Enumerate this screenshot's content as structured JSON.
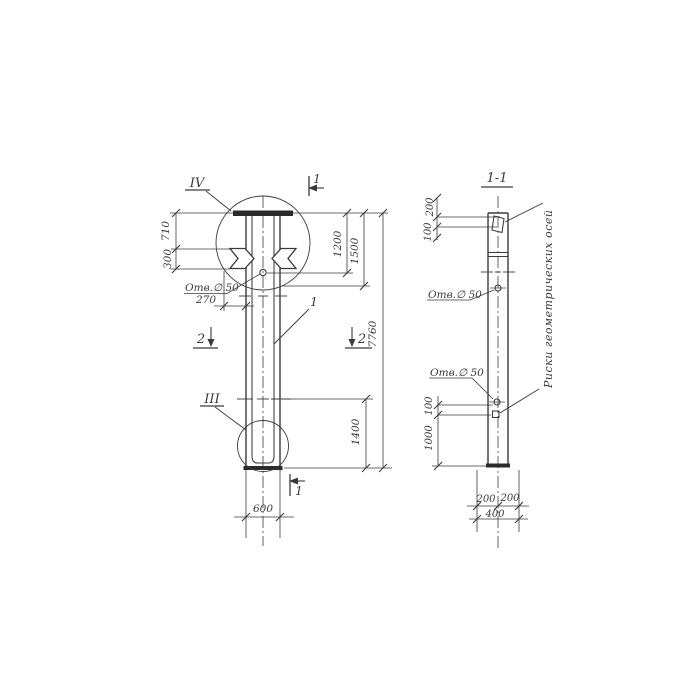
{
  "drawing": {
    "background": "#ffffff",
    "ink": "#3a3a3a",
    "labels": {
      "detail_top": "IV",
      "detail_bottom": "III",
      "section_title": "1-1",
      "section_cut_1": "1",
      "section_cut_2": "2",
      "part_ref": "1",
      "hole": "Отв.∅ 50",
      "axes_note": "Риски геометрических осей"
    },
    "elevation_dims": {
      "d710": "710",
      "d300": "300",
      "d270": "270",
      "d600": "600",
      "d1200": "1200",
      "d1500": "1500",
      "d7760": "7760",
      "d1400": "1400"
    },
    "section_dims": {
      "top_200": "200",
      "top_100": "100",
      "mid_100": "100",
      "mid_1000": "1000",
      "bot_200a": "200",
      "bot_200b": "200",
      "bot_400": "400"
    }
  }
}
